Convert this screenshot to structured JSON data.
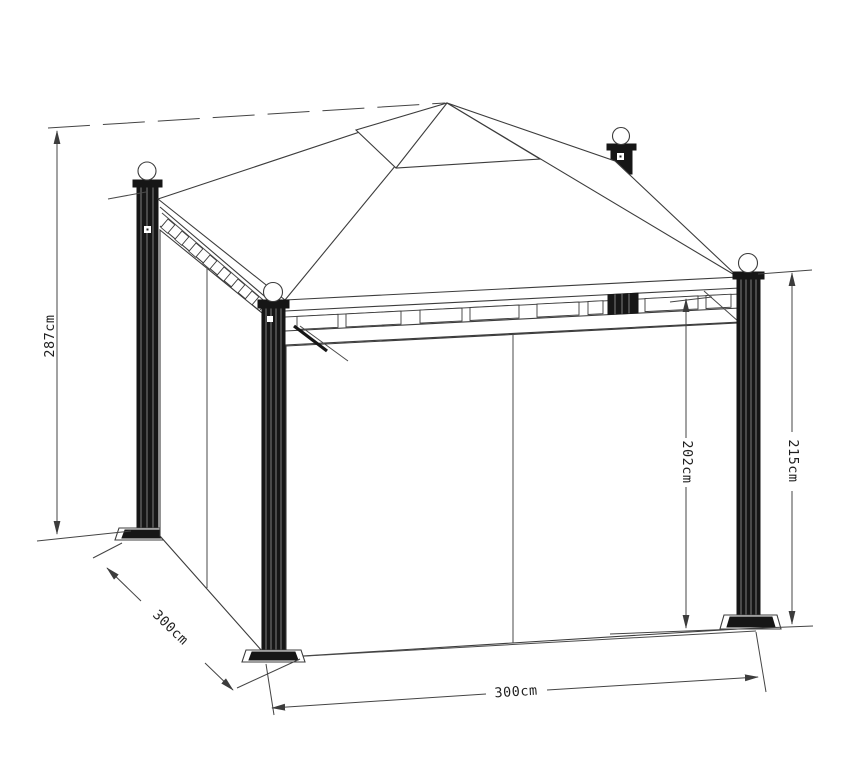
{
  "dims": {
    "total_height": "287cm",
    "side_depth": "300cm",
    "inner_height": "202cm",
    "post_height": "215cm",
    "front_width": "300cm"
  },
  "colors": {
    "ink": "#3c3c3c",
    "background": "#ffffff"
  }
}
